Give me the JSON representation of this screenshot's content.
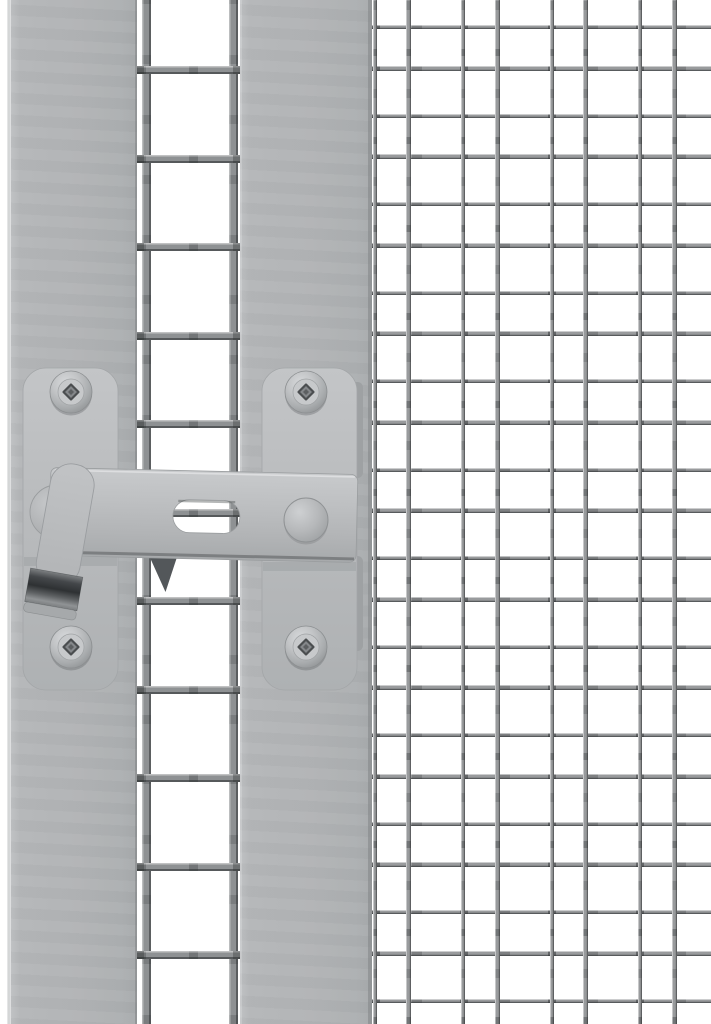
{
  "meta": {
    "type": "product-photo",
    "subject": "Gray steel gate latch with slotted bar and lever handle mounted between a mesh gate frame and a wire mesh panel",
    "text_content": "none"
  },
  "palette": {
    "white": "#ffffff",
    "edge_line": "#d2d3d4",
    "post": "#b1b4b6",
    "plate": "#bdbfc1",
    "bar": "#babcbe",
    "wire_big": "#8e9193",
    "wire_fine": "#999b9d",
    "steel_dark": "#2e3133",
    "strip_dark": "#9ea1a3",
    "wedge_dark": "#53575a"
  },
  "posts": {
    "left": {
      "x": 11,
      "width": 126
    },
    "center": {
      "x": 240,
      "width": 132
    }
  },
  "mid_mesh": {
    "x": 137,
    "width": 103,
    "v_wires_x": [
      141.5,
      228.5
    ],
    "v_wire_width": 9,
    "h_start": 66,
    "h_period": 88.5,
    "h_wire_height": 8,
    "h_end": 1034
  },
  "fine_mesh": {
    "x": 372,
    "width": 339,
    "right_limit": 711,
    "bottom_limit": 1024,
    "v_families": [
      {
        "start": 372.5,
        "period": 88.5,
        "width": 4
      },
      {
        "start": 406.0,
        "period": 88.5,
        "width": 5
      }
    ],
    "h_families": [
      {
        "start": 25.0,
        "period": 88.5,
        "height": 4
      },
      {
        "start": 65.5,
        "period": 88.5,
        "height": 5
      }
    ]
  },
  "latch": {
    "plates": {
      "left_x": 23,
      "right_x": 262,
      "y": 368,
      "width": 95,
      "height": 322,
      "corner_radius": 23
    },
    "screw_centers": [
      [
        71,
        392
      ],
      [
        306,
        392
      ],
      [
        71,
        647
      ],
      [
        306,
        647
      ]
    ],
    "screw_radius": 21,
    "bar": {
      "x1": 50,
      "x2": 357,
      "y": 471,
      "height": 88,
      "tilt_deg": 1.3
    },
    "slot": {
      "x1": 173,
      "x2": 240,
      "y1": 500,
      "y2": 533
    },
    "pivot_disc": {
      "cx": 57,
      "cy": 512,
      "r": 27
    },
    "knob": {
      "cx": 306,
      "cy": 520,
      "r": 22
    },
    "lever": {
      "top_cx": 72,
      "top_cy": 486,
      "width": 44,
      "length": 144,
      "angle_deg": 10
    },
    "parts": [
      "mounting-plate-left",
      "mounting-plate-right",
      "screws",
      "latch-bar",
      "bar-slot",
      "pivot-disc",
      "lever-handle",
      "steel-tip",
      "pull-knob",
      "catch-wedge",
      "post-strips"
    ]
  }
}
